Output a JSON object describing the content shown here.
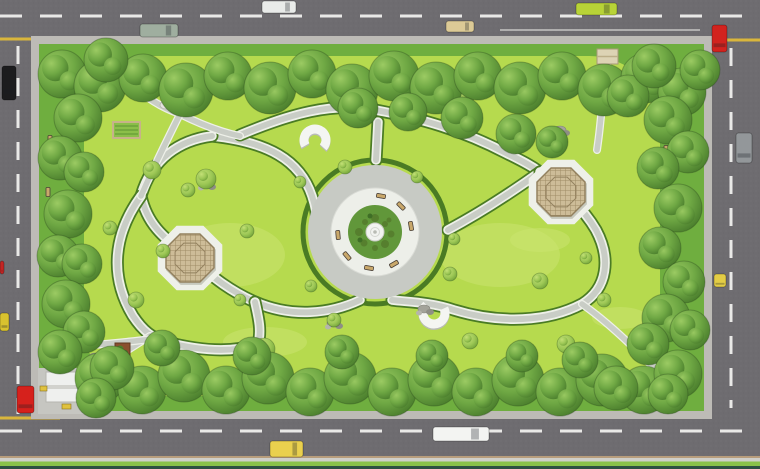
{
  "meta": {
    "title": "Aerial top-view render of a rectangular city park landscape plan",
    "canvas": {
      "width": 760,
      "height": 469
    }
  },
  "palette": {
    "asphalt": "#6e6c70",
    "road_dash": "#e9e9e7",
    "yellow_line": "#d9b63c",
    "sidewalk": "#bdbbb6",
    "grass_base": "#6fae3f",
    "lawn": "#b6da4e",
    "lawn_light": "#cbe470",
    "hedge": "#4a7b24",
    "path_white": "#eef0e9",
    "path_gray": "#c9cdc6",
    "plaza_gray": "#c7cac4",
    "plaza_white": "#edefe9",
    "plaza_green": "#61973a",
    "pergola_wood": "#cdbc98",
    "pergola_line": "#a08c66",
    "tree_dark": "#497c2c",
    "tree_mid": "#6fa844",
    "tree_light": "#9ccb63",
    "curb_tan": "#b79d7c",
    "strip_green": "#8ac14a",
    "strip_dark": "#2e4f42",
    "bench_wood": "#c9a86b",
    "structure_white": "#eff0ee"
  },
  "scene": {
    "plaza": {
      "cx": 375,
      "cy": 232,
      "hedge_r": 72,
      "gray_r": 67,
      "white_r": 44,
      "green_r": 27,
      "fountain_r": 9,
      "plants": [
        [
          0,
          -14,
          4
        ],
        [
          10,
          -8,
          3
        ],
        [
          16,
          2,
          3.5
        ],
        [
          10,
          12,
          4
        ],
        [
          0,
          16,
          3
        ],
        [
          -11,
          11,
          3.5
        ],
        [
          -16,
          0,
          4
        ],
        [
          -10,
          -10,
          3
        ],
        [
          -3,
          3,
          5
        ],
        [
          6,
          4,
          3
        ],
        [
          -5,
          -16,
          2.5
        ],
        [
          14,
          -12,
          2.5
        ],
        [
          -15,
          8,
          2.5
        ],
        [
          4,
          -5,
          2.5
        ]
      ]
    },
    "pergolas": [
      {
        "name": "pergola-west",
        "cx": 190,
        "cy": 258,
        "r": 26,
        "pad_r": 35
      },
      {
        "name": "pergola-east",
        "cx": 561,
        "cy": 192,
        "r": 26,
        "pad_r": 35
      }
    ],
    "horseshoes": [
      {
        "name": "horseshoe-bench-north",
        "cx": 315,
        "cy": 140,
        "r": 11,
        "gap_deg": 110,
        "gap_dir": 95
      },
      {
        "name": "horseshoe-bench-south",
        "cx": 434,
        "cy": 313,
        "r": 11,
        "gap_deg": 110,
        "gap_dir": -80
      }
    ],
    "vehicles": [
      {
        "name": "truck-sage-top",
        "color": "#9fae9f",
        "x": 140,
        "y": 24,
        "w": 38,
        "h": 13,
        "dir": "h"
      },
      {
        "name": "car-white-top",
        "color": "#e9ebe9",
        "x": 262,
        "y": 1,
        "w": 34,
        "h": 12,
        "dir": "h"
      },
      {
        "name": "car-beige-top",
        "color": "#dcca96",
        "x": 446,
        "y": 21,
        "w": 28,
        "h": 11,
        "dir": "h"
      },
      {
        "name": "bus-lime-top",
        "color": "#b8d337",
        "x": 576,
        "y": 3,
        "w": 41,
        "h": 12,
        "dir": "h"
      },
      {
        "name": "car-red-topright",
        "color": "#d2231e",
        "x": 712,
        "y": 25,
        "w": 15,
        "h": 27,
        "dir": "v"
      },
      {
        "name": "van-gray-right",
        "color": "#93979a",
        "x": 736,
        "y": 133,
        "w": 16,
        "h": 30,
        "dir": "v"
      },
      {
        "name": "car-yellow-right",
        "color": "#e3cd46",
        "x": 714,
        "y": 274,
        "w": 12,
        "h": 13,
        "dir": "v"
      },
      {
        "name": "truck-black-left",
        "color": "#1c1c1e",
        "x": 2,
        "y": 66,
        "w": 14,
        "h": 34,
        "dir": "v"
      },
      {
        "name": "car-red-left",
        "color": "#d6211c",
        "x": 17,
        "y": 386,
        "w": 17,
        "h": 27,
        "dir": "v"
      },
      {
        "name": "car-yellow-left-edge",
        "color": "#d9c22f",
        "x": 0,
        "y": 313,
        "w": 9,
        "h": 18,
        "dir": "v"
      },
      {
        "name": "car-red-sliver-left",
        "color": "#c32523",
        "x": 0,
        "y": 261,
        "w": 4,
        "h": 13,
        "dir": "v"
      },
      {
        "name": "taxi-yellow-bottom",
        "color": "#ead04e",
        "x": 270,
        "y": 441,
        "w": 33,
        "h": 16,
        "dir": "h"
      },
      {
        "name": "bus-white-bottom",
        "color": "#f3f4f2",
        "x": 433,
        "y": 427,
        "w": 56,
        "h": 14,
        "dir": "h"
      }
    ],
    "trees_border": [
      [
        62,
        74,
        24
      ],
      [
        100,
        86,
        26
      ],
      [
        143,
        78,
        24
      ],
      [
        186,
        90,
        27
      ],
      [
        228,
        76,
        24
      ],
      [
        270,
        88,
        26
      ],
      [
        312,
        74,
        24
      ],
      [
        352,
        90,
        26
      ],
      [
        394,
        76,
        25
      ],
      [
        436,
        88,
        26
      ],
      [
        478,
        76,
        24
      ],
      [
        520,
        88,
        26
      ],
      [
        562,
        76,
        24
      ],
      [
        604,
        90,
        26
      ],
      [
        646,
        78,
        25
      ],
      [
        682,
        92,
        24
      ],
      [
        700,
        70,
        20
      ],
      [
        106,
        60,
        22
      ],
      [
        358,
        108,
        20
      ],
      [
        408,
        112,
        19
      ],
      [
        462,
        118,
        21
      ],
      [
        516,
        134,
        20
      ],
      [
        552,
        142,
        16
      ],
      [
        628,
        96,
        21
      ],
      [
        654,
        66,
        22
      ],
      [
        78,
        118,
        24
      ],
      [
        60,
        158,
        22
      ],
      [
        84,
        172,
        20
      ],
      [
        68,
        214,
        24
      ],
      [
        58,
        256,
        21
      ],
      [
        82,
        264,
        20
      ],
      [
        66,
        304,
        24
      ],
      [
        84,
        332,
        21
      ],
      [
        60,
        352,
        22
      ],
      [
        668,
        120,
        24
      ],
      [
        688,
        152,
        21
      ],
      [
        658,
        168,
        21
      ],
      [
        678,
        208,
        24
      ],
      [
        660,
        248,
        21
      ],
      [
        684,
        282,
        21
      ],
      [
        666,
        318,
        24
      ],
      [
        648,
        344,
        21
      ],
      [
        690,
        330,
        20
      ],
      [
        100,
        378,
        25
      ],
      [
        142,
        390,
        24
      ],
      [
        184,
        376,
        26
      ],
      [
        226,
        390,
        24
      ],
      [
        268,
        378,
        26
      ],
      [
        310,
        392,
        24
      ],
      [
        350,
        378,
        26
      ],
      [
        392,
        392,
        24
      ],
      [
        434,
        380,
        26
      ],
      [
        476,
        392,
        24
      ],
      [
        518,
        380,
        26
      ],
      [
        560,
        392,
        24
      ],
      [
        602,
        380,
        26
      ],
      [
        644,
        390,
        24
      ],
      [
        678,
        374,
        24
      ],
      [
        162,
        348,
        18
      ],
      [
        252,
        356,
        19
      ],
      [
        342,
        352,
        17
      ],
      [
        432,
        356,
        16
      ],
      [
        522,
        356,
        16
      ],
      [
        580,
        360,
        18
      ],
      [
        112,
        368,
        22
      ],
      [
        96,
        398,
        20
      ],
      [
        616,
        388,
        22
      ],
      [
        668,
        394,
        20
      ]
    ],
    "shrubs": [
      [
        152,
        170,
        9
      ],
      [
        206,
        179,
        10
      ],
      [
        247,
        231,
        7
      ],
      [
        163,
        251,
        7
      ],
      [
        110,
        228,
        7
      ],
      [
        136,
        300,
        8
      ],
      [
        264,
        349,
        11
      ],
      [
        334,
        320,
        7
      ],
      [
        356,
        80,
        9
      ],
      [
        430,
        88,
        9
      ],
      [
        467,
        97,
        7
      ],
      [
        621,
        106,
        8
      ],
      [
        655,
        170,
        8
      ],
      [
        450,
        274,
        7
      ],
      [
        540,
        281,
        8
      ],
      [
        566,
        344,
        9
      ],
      [
        470,
        341,
        8
      ],
      [
        300,
        182,
        6
      ],
      [
        345,
        167,
        7
      ],
      [
        417,
        177,
        6
      ],
      [
        454,
        239,
        6
      ],
      [
        311,
        286,
        6
      ],
      [
        604,
        300,
        7
      ],
      [
        586,
        258,
        6
      ],
      [
        188,
        190,
        7
      ],
      [
        240,
        300,
        6
      ]
    ],
    "rocks": [
      [
        620,
        103
      ],
      [
        333,
        323
      ],
      [
        206,
        184
      ],
      [
        424,
        309
      ],
      [
        95,
        357
      ],
      [
        560,
        130
      ]
    ],
    "sculpture": {
      "name": "white-stone-sculpture",
      "x": 168,
      "y": 106
    },
    "light_patches": [
      [
        265,
        342,
        42,
        15
      ],
      [
        455,
        88,
        45,
        13
      ],
      [
        130,
        84,
        22,
        9
      ],
      [
        620,
        318,
        28,
        11
      ],
      [
        230,
        255,
        55,
        32
      ],
      [
        500,
        255,
        60,
        32
      ],
      [
        540,
        240,
        30,
        12
      ]
    ],
    "benches_plaza": [
      [
        381,
        196,
        10
      ],
      [
        401,
        206,
        45
      ],
      [
        411,
        226,
        80
      ],
      [
        394,
        264,
        150
      ],
      [
        369,
        268,
        190
      ],
      [
        347,
        256,
        230
      ],
      [
        338,
        235,
        265
      ]
    ],
    "benches_border": [
      [
        50,
        140,
        90
      ],
      [
        48,
        192,
        90
      ],
      [
        50,
        243,
        90
      ],
      [
        48,
        295,
        90
      ],
      [
        666,
        150,
        90
      ],
      [
        664,
        202,
        90
      ],
      [
        666,
        254,
        90
      ],
      [
        664,
        306,
        90
      ]
    ],
    "structures": {
      "pavilion": {
        "name": "corner-pavilion",
        "x": 46,
        "y": 372,
        "w": 32,
        "h": 30
      },
      "canopy": {
        "name": "entrance-canopy-northeast",
        "x": 597,
        "y": 49,
        "w": 21,
        "h": 15
      },
      "steps_a": {
        "name": "entrance-steps-west-upper",
        "x": 113,
        "y": 68,
        "w": 27,
        "h": 24
      },
      "steps_b": {
        "name": "entrance-steps-west-lower",
        "x": 113,
        "y": 122,
        "w": 27,
        "h": 16
      },
      "planter": {
        "name": "square-planter",
        "x": 115,
        "y": 343,
        "w": 15,
        "h": 15
      },
      "pavilion_benches": [
        [
          40,
          386,
          7,
          5
        ],
        [
          62,
          404,
          9,
          5
        ]
      ]
    }
  }
}
